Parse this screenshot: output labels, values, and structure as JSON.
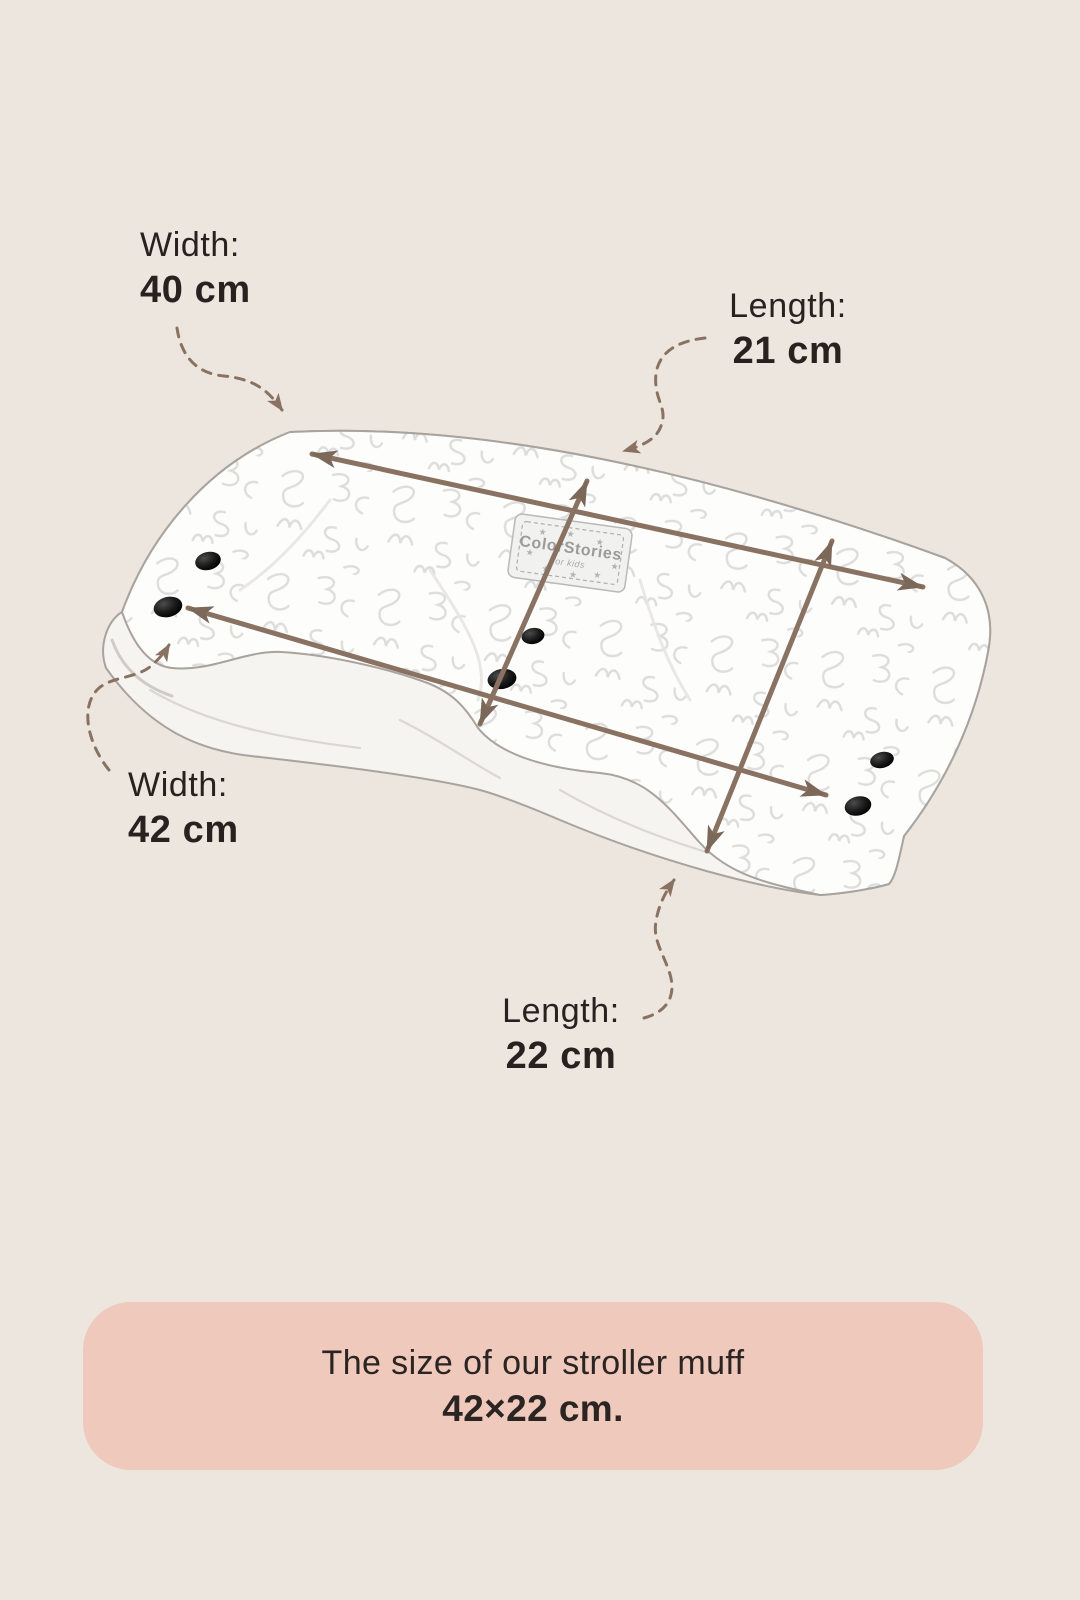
{
  "page": {
    "background": "#ECE6DE",
    "description": "Stroller muff dimensions infographic"
  },
  "colors": {
    "arrow_brown": "#8A7262",
    "arrow_head": "#7C6859",
    "text_dark": "#272220",
    "banner_bg": "#EFC9BB",
    "fabric_outline": "#A8A39D",
    "pattern_gray": "#D7D7D7"
  },
  "icons": {
    "star": "★"
  },
  "measurements": {
    "top_width": {
      "label": "Width:",
      "value": "40 cm"
    },
    "top_length": {
      "label": "Length:",
      "value": "21 cm"
    },
    "left_width": {
      "label": "Width:",
      "value": "42 cm"
    },
    "bottom_length": {
      "label": "Length:",
      "value": "22 cm"
    }
  },
  "product": {
    "label_line1": "ColorStories",
    "label_line2": "for kids",
    "snap_count": 6
  },
  "banner": {
    "line1": "The size of our stroller muff",
    "line2": "42×22 cm."
  }
}
